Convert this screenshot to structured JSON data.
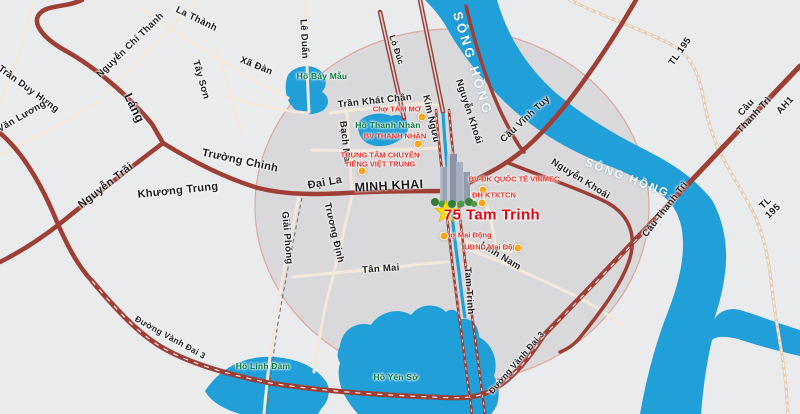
{
  "map": {
    "title": "75 Tam Trinh location map",
    "colors": {
      "bg": "#eaebed",
      "circle_fill": "#d9d9db",
      "circle_edge": "#dfa79e",
      "water": "#219fd9",
      "road_major": "#9e3e35",
      "street_text": "#1d1d1f",
      "river_text": "#ffffff",
      "lake_text": "#0e7a3a",
      "poi_text": "#e5342c",
      "highlight_text": "#e20613",
      "poi_dot": "#f9a61a",
      "star": "#ffd900"
    },
    "labels": [
      {
        "id": "tran-duy-hung",
        "text": "Trần Duy Hưng",
        "x": 28,
        "y": 90,
        "rot": 36,
        "cls": "st"
      },
      {
        "id": "nguyen-chi-thanh",
        "text": "Nguyễn Chí Thanh",
        "x": 131,
        "y": 46,
        "rot": -44,
        "cls": "st"
      },
      {
        "id": "la-thanh",
        "text": "La Thành",
        "x": 196,
        "y": 20,
        "rot": 26,
        "cls": "st"
      },
      {
        "id": "tay-son",
        "text": "Tây Sơn",
        "x": 200,
        "y": 80,
        "rot": 74,
        "cls": "st"
      },
      {
        "id": "xa-dan",
        "text": "Xã Đàn",
        "x": 256,
        "y": 67,
        "rot": 22,
        "cls": "st"
      },
      {
        "id": "le-van-luong",
        "text": "Lê Văn Lương",
        "x": 16,
        "y": 121,
        "rot": -30,
        "cls": "st"
      },
      {
        "id": "lang",
        "text": "Láng",
        "x": 134,
        "y": 108,
        "rot": 64,
        "cls": "st-xl"
      },
      {
        "id": "nguyen-trai",
        "text": "Nguyễn Trãi",
        "x": 106,
        "y": 186,
        "rot": -38,
        "cls": "st-lg"
      },
      {
        "id": "truong-chinh",
        "text": "Trường Chinh",
        "x": 240,
        "y": 161,
        "rot": 12,
        "cls": "st-lg"
      },
      {
        "id": "khuong-trung",
        "text": "Khương Trung",
        "x": 178,
        "y": 191,
        "rot": -6,
        "cls": "st-lg"
      },
      {
        "id": "le-duan",
        "text": "Lê Duẩn",
        "x": 303,
        "y": 39,
        "rot": 87,
        "cls": "st"
      },
      {
        "id": "lo-duc",
        "text": "Lò Đúc",
        "x": 396,
        "y": 50,
        "rot": 72,
        "cls": "st-sm"
      },
      {
        "id": "kim-nguu",
        "text": "Kim Ngưu",
        "x": 430,
        "y": 119,
        "rot": 77,
        "cls": "st"
      },
      {
        "id": "nguyen-khoai-1",
        "text": "Nguyễn Khoái",
        "x": 468,
        "y": 112,
        "rot": 72,
        "cls": "st"
      },
      {
        "id": "nguyen-khoai-2",
        "text": "Nguyễn Khoái",
        "x": 580,
        "y": 180,
        "rot": 32,
        "cls": "st"
      },
      {
        "id": "cau-vinh-tuy",
        "text": "Cầu Vĩnh Tuy",
        "x": 526,
        "y": 120,
        "rot": -43,
        "cls": "st"
      },
      {
        "id": "cau-thanh-tri-1",
        "text": "Cầu Thanh Trì",
        "x": 751,
        "y": 112,
        "rot": -47,
        "cls": "st"
      },
      {
        "id": "ah1",
        "text": "AH1",
        "x": 786,
        "y": 106,
        "rot": -47,
        "cls": "st"
      },
      {
        "id": "cau-thanh-tri-2",
        "text": "Cầu Thanh Trì",
        "x": 666,
        "y": 210,
        "rot": -52,
        "cls": "st"
      },
      {
        "id": "tl-195-1",
        "text": "TL 195",
        "x": 681,
        "y": 52,
        "rot": -55,
        "cls": "st"
      },
      {
        "id": "tl-195-2",
        "text": "TL 195",
        "x": 770,
        "y": 208,
        "rot": -43,
        "cls": "st"
      },
      {
        "id": "dai-la",
        "text": "Đại La",
        "x": 325,
        "y": 183,
        "rot": -10,
        "cls": "st-lg"
      },
      {
        "id": "minh-khai",
        "text": "MINH KHAI",
        "x": 389,
        "y": 186,
        "rot": -3,
        "cls": "st-xl"
      },
      {
        "id": "tran-khat-chan",
        "text": "Trần Khát Chân",
        "x": 375,
        "y": 102,
        "rot": -6,
        "cls": "st"
      },
      {
        "id": "bach-mai",
        "text": "Bạch Mai",
        "x": 344,
        "y": 143,
        "rot": 84,
        "cls": "st"
      },
      {
        "id": "giai-phong",
        "text": "Giải Phóng",
        "x": 286,
        "y": 238,
        "rot": 85,
        "cls": "st"
      },
      {
        "id": "truong-dinh",
        "text": "Trương Định",
        "x": 333,
        "y": 233,
        "rot": 77,
        "cls": "st"
      },
      {
        "id": "tan-mai",
        "text": "Tân Mai",
        "x": 381,
        "y": 270,
        "rot": -4,
        "cls": "st"
      },
      {
        "id": "tam-trinh",
        "text": "Tam Trinh",
        "x": 468,
        "y": 291,
        "rot": 86,
        "cls": "st"
      },
      {
        "id": "linh-nam",
        "text": "Lĩnh Nam",
        "x": 500,
        "y": 257,
        "rot": 31,
        "cls": "st"
      },
      {
        "id": "vanh-dai-3-1",
        "text": "Đường Vành Đai 3",
        "x": 170,
        "y": 338,
        "rot": 29,
        "cls": "st-sm"
      },
      {
        "id": "vanh-dai-3-2",
        "text": "Đường Vành Đai 3",
        "x": 517,
        "y": 363,
        "rot": -49,
        "cls": "st-sm"
      },
      {
        "id": "song-hong-1",
        "text": "SÔNG HỒNG",
        "x": 472,
        "y": 64,
        "rot": 73,
        "cls": "rv"
      },
      {
        "id": "song-hong-2",
        "text": "SÔNG HỒNG",
        "x": 627,
        "y": 179,
        "rot": 21,
        "cls": "rv-sm"
      },
      {
        "id": "ho-bay-mau",
        "text": "Hồ Bảy Mẫu",
        "x": 322,
        "y": 77,
        "rot": 0,
        "cls": "lk"
      },
      {
        "id": "ho-thanh-nhan",
        "text": "Hồ Thanh Nhàn",
        "x": 388,
        "y": 126,
        "rot": 0,
        "cls": "lk"
      },
      {
        "id": "ho-linh-dam",
        "text": "Hồ Linh Đàm",
        "x": 263,
        "y": 367,
        "rot": 0,
        "cls": "lk"
      },
      {
        "id": "ho-yen-so",
        "text": "Hồ Yên Sở",
        "x": 396,
        "y": 378,
        "rot": 0,
        "cls": "lk"
      },
      {
        "id": "75-tam-trinh",
        "text": "75 Tam Trinh",
        "x": 492,
        "y": 215,
        "rot": 0,
        "cls": "hl"
      }
    ],
    "pois": [
      {
        "id": "cho-tam-mo",
        "text": "Chợ TÁM MƠ",
        "x": 397,
        "y": 110,
        "dot": [
          422,
          117
        ]
      },
      {
        "id": "bv-thanh-nhan",
        "text": "BV THANH NHÀN",
        "x": 395,
        "y": 137,
        "dot": [
          418,
          144
        ]
      },
      {
        "id": "trung-tam-tieng-viet-trung",
        "text": "TRUNG TÂM CHUYÊN\nTIẾNG VIỆT TRUNG",
        "x": 380,
        "y": 160,
        "dot": [
          362,
          171
        ]
      },
      {
        "id": "vinmec",
        "text": "BV-ĐK QUỐC TẾ VINMEC",
        "x": 514,
        "y": 180,
        "dot": [
          483,
          190
        ]
      },
      {
        "id": "dh-ktktcn",
        "text": "ĐH KTKTCN",
        "x": 494,
        "y": 196,
        "dot": [
          482,
          203
        ]
      },
      {
        "id": "cho-mai-dong",
        "text": "Chợ Mai Động",
        "x": 466,
        "y": 236,
        "dot": [
          444,
          236
        ]
      },
      {
        "id": "ubnd-mai-dong",
        "text": "UBND Mai Động",
        "x": 493,
        "y": 248,
        "dot": [
          518,
          248
        ]
      }
    ]
  }
}
